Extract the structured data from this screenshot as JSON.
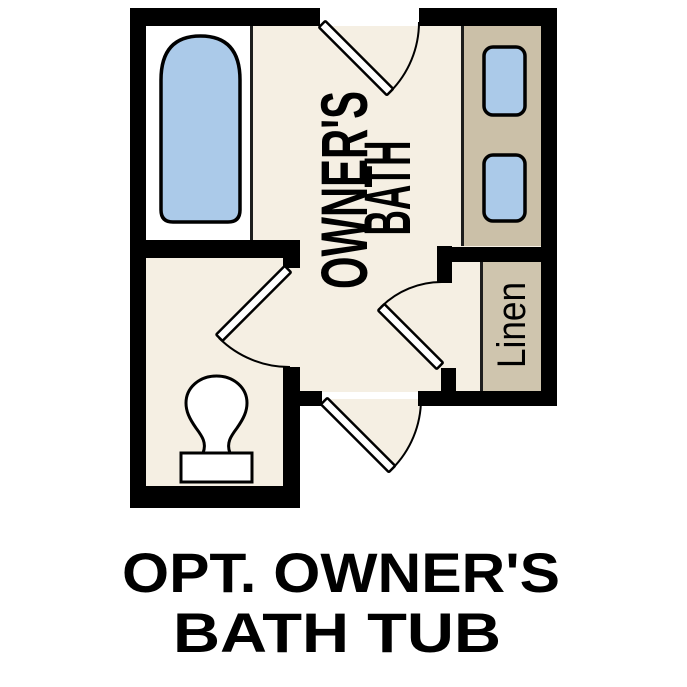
{
  "plan": {
    "room": {
      "label_line1": "OWNER'S",
      "label_line2": "BATH"
    },
    "linen": {
      "label": "Linen"
    },
    "caption": {
      "line1": "OPT. OWNER'S",
      "line2": "BATH TUB"
    },
    "fixtures": {
      "tub": "bathtub",
      "vanity": "double-sink-vanity",
      "toilet": "toilet",
      "linen_closet": "linen-closet",
      "doors": "swing-doors"
    },
    "colors": {
      "wall": "#000000",
      "floor": "#f5efe3",
      "counter": "#cbc0a8",
      "linen_shelf": "#cfc5ae",
      "fixture_blue": "#abcae9",
      "alcove_white": "#ffffff",
      "text": "#000000"
    }
  }
}
